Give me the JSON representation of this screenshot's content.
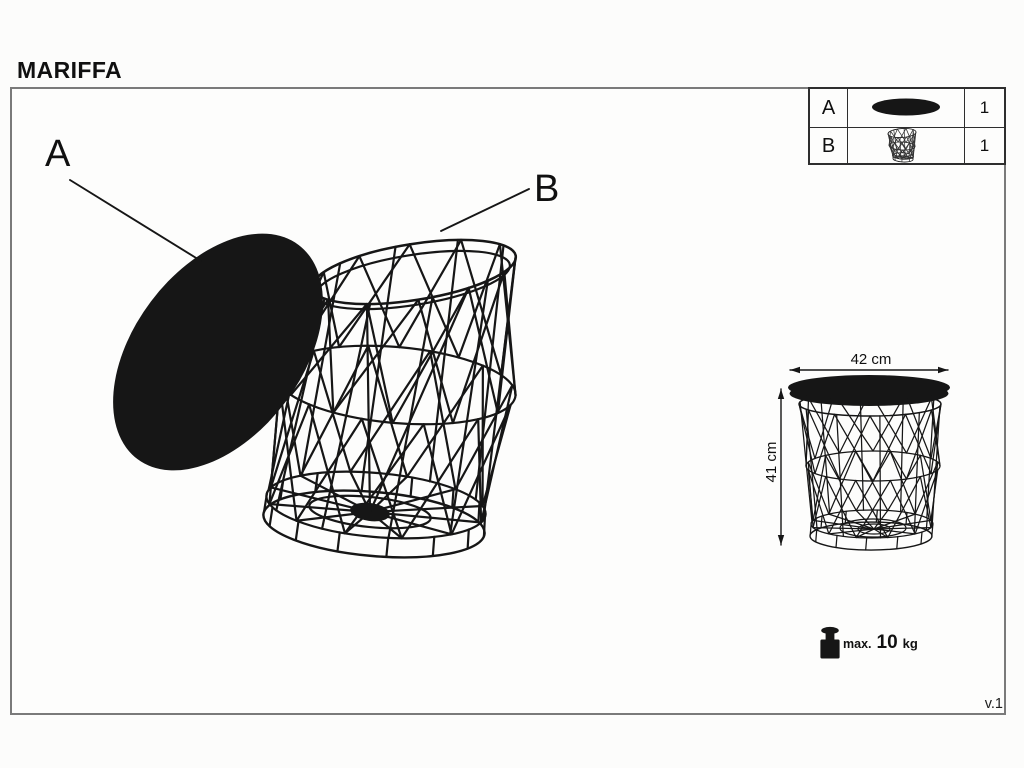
{
  "page": {
    "title": "MARIFFA",
    "version": "v.1"
  },
  "colors": {
    "ink": "#161616",
    "frame_border": "#7a7a7a",
    "table_border": "#2e2e2e"
  },
  "parts_table": {
    "rows": [
      {
        "letter": "A",
        "icon": "table-lid-icon",
        "qty": "1"
      },
      {
        "letter": "B",
        "icon": "wire-basket-icon",
        "qty": "1"
      }
    ]
  },
  "callouts": {
    "a": "A",
    "b": "B"
  },
  "dimensions": {
    "width": "42 cm",
    "height": "41 cm"
  },
  "max_load": {
    "icon": "weight-icon",
    "prefix": "max.",
    "value": "10",
    "unit": "kg"
  }
}
